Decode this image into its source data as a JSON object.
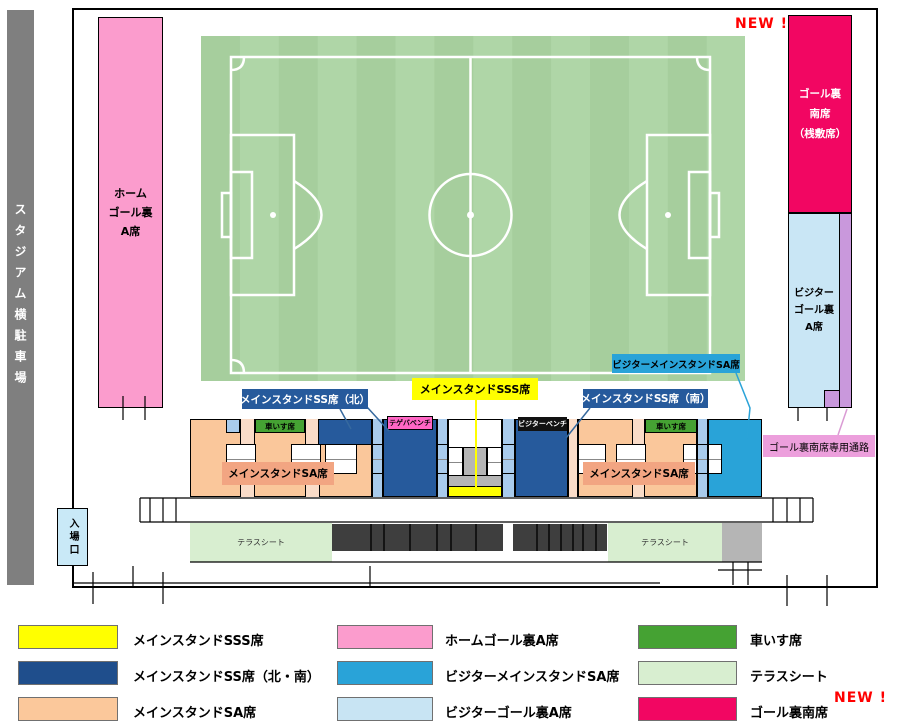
{
  "map": {
    "parking_label": "スタジアム横駐車場",
    "entrance_label": "入場口",
    "new_badge": "NEW !",
    "home_goal_lines": [
      "ホーム",
      "ゴール裏",
      "A席"
    ],
    "south_goal_lines": [
      "ゴール裏",
      "南席",
      "（桟敷席）"
    ],
    "visitor_goal_lines": [
      "ビジター",
      "ゴール裏",
      "A席"
    ],
    "corridor_label": "ゴール裏南席専用通路",
    "callout_sss": "メインスタンドSSS席",
    "callout_ss_north": "メインスタンドSS席（北）",
    "callout_ss_south": "メインスタンドSS席（南）",
    "callout_visitor_sa": "ビジターメインスタンドSA席",
    "sa_stand_label": "メインスタンドSA席",
    "wheelchair_label": "車いす席",
    "home_bench_label": "テゲバベンチ",
    "visitor_bench_label": "ビジターベンチ",
    "terrace_label": "テラスシート"
  },
  "legend": {
    "new_badge": "NEW !",
    "items": [
      {
        "id": "sss",
        "label": "メインスタンドSSS席",
        "color": "#ffff00"
      },
      {
        "id": "ss-north-south",
        "label": "メインスタンドSS席（北・南）",
        "color": "#1f4e8c"
      },
      {
        "id": "sa",
        "label": "メインスタンドSA席",
        "color": "#fbc89b"
      },
      {
        "id": "home-goal-a",
        "label": "ホームゴール裏A席",
        "color": "#fb9ccd"
      },
      {
        "id": "visitor-sa",
        "label": "ビジターメインスタンドSA席",
        "color": "#29a3d8"
      },
      {
        "id": "visitor-goal-a",
        "label": "ビジターゴール裏A席",
        "color": "#c8e4f3"
      },
      {
        "id": "wheelchair",
        "label": "車いす席",
        "color": "#45a233"
      },
      {
        "id": "terrace",
        "label": "テラスシート",
        "color": "#d8eed0"
      },
      {
        "id": "south-goal",
        "label": "ゴール裏南席",
        "color": "#f20662"
      }
    ]
  },
  "colors": {
    "pitch_stripe_dark": "#a6ce9d",
    "pitch_stripe_light": "#afd6a7",
    "pitch_lines": "#ffffff",
    "parking_gray": "#7f7f7f",
    "seat_dark_blue": "#265a9c",
    "seat_orange": "#fac79b",
    "seat_visitor_blue": "#29a3d8",
    "seat_yellow": "#ffff00",
    "corridor_purple": "#c998dc",
    "new_badge_red": "#ff0000"
  }
}
